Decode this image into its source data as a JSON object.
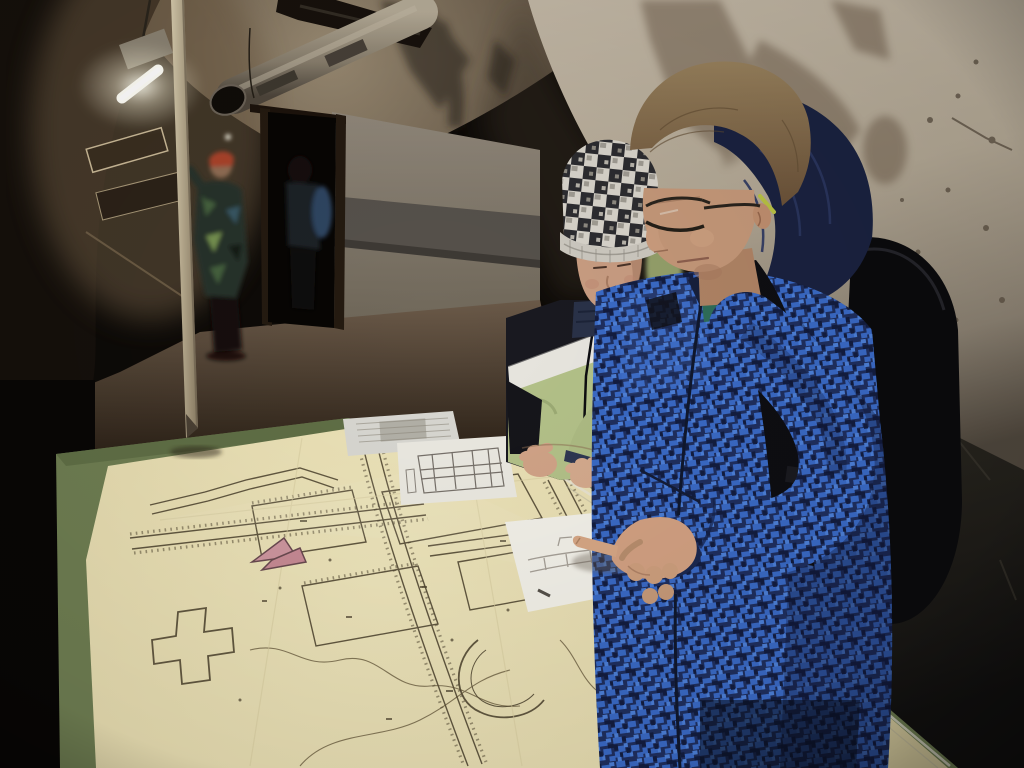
{
  "meta": {
    "kind": "photograph",
    "scene": "Two boys study historical fortification floor plans on a glass-covered map table inside a dim vaulted bunker corridor"
  },
  "aria": {
    "photo": "Two boys studying fortification floor plans on a green map table in a dim bunker corridor",
    "tunnel": "dim vaulted bunker corridor",
    "ceiling_pipe": "large metal ventilation pipe under the ceiling",
    "fluorescent_light": "fluorescent tube light on the left wall",
    "doorway": "dark doorway with visitors beyond",
    "background_visitor": "child in camouflage jacket and red knit hat",
    "support_pole": "pale wooden pole leaning across the corridor",
    "map_table": "green table with glass-covered fortification map",
    "fortification_map": "yellowed fortification floor plan with hatched corridors",
    "map_arrow_marker": "pink location arrow drawn on the map",
    "info_sheet_a": "white information sheet on the table",
    "info_sheet_b": "white sheet with small floor plan",
    "info_sheet_c": "white sheet with sketched plan being pointed at",
    "younger_boy": "younger boy in checkered knit hat and green-black jacket",
    "older_boy": "older boy in blue camouflage jacket with glasses and backpack",
    "pointing_hand": "hand pointing at the sketched plan"
  },
  "palette": {
    "tunnel_dark": "#0d0a07",
    "ceiling_light": "#97876f",
    "right_wall": "#bcb09d",
    "wall_stain": "#6e5d4b",
    "table_green": "#6f7e52",
    "map_cream": "#ece2b4",
    "map_ink": "#4a402c",
    "marker_pink": "#cf97a0",
    "paper_white": "#f4f2ea",
    "jacket_blue": "#3a6ac6",
    "jacket_navy": "#1f2f5f",
    "jacket_pistachio": "#b4c289",
    "hat_light": "#d8d4cb",
    "hat_dark": "#2c2c30",
    "skin": "#c59879",
    "hair_brown": "#8a7250",
    "backpack_black": "#0b0b0d"
  }
}
